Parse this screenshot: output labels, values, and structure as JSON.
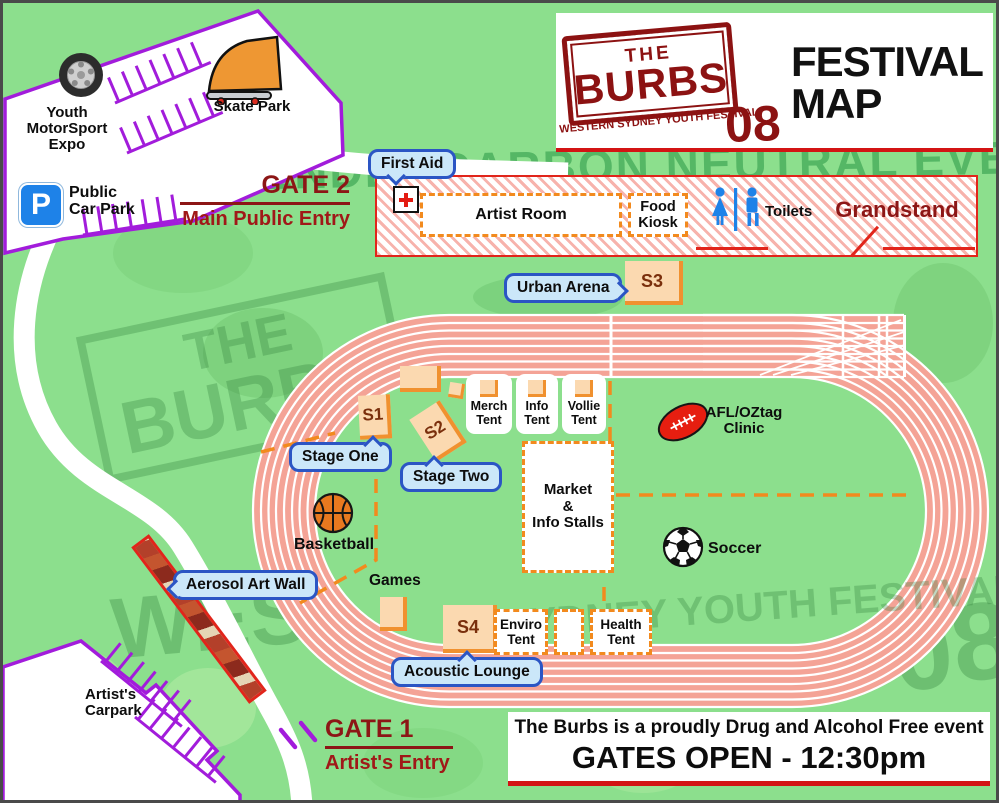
{
  "header": {
    "logo_the": "THE",
    "logo_burbs": "BURBS",
    "logo_tagline": "WESTERN SYDNEY YOUTH FESTIVAL",
    "logo_year": "08",
    "title_line1": "FESTIVAL",
    "title_line2": "MAP"
  },
  "watermarks": {
    "top": "A FRIENDLY CARBON NEUTRAL EVENT",
    "big_left_line1": "THE",
    "big_left_line2": "BURBS",
    "bottom_large": "WESTERN",
    "bottom_small": "SYDNEY YOUTH FESTIVAL",
    "year": "08"
  },
  "carparks": {
    "expo_label": "Youth MotorSport Expo",
    "skate_label": "Skate Park",
    "public_sign_letter": "P",
    "public_label": "Public Car Park",
    "artist_label": "Artist's Carpark"
  },
  "gates": {
    "gate2_title": "GATE 2",
    "gate2_subtitle": "Main Public Entry",
    "gate1_title": "GATE 1",
    "gate1_subtitle": "Artist's Entry"
  },
  "grandstand": {
    "title": "Grandstand",
    "artist_room": "Artist Room",
    "food_kiosk": "Food Kiosk",
    "toilets": "Toilets"
  },
  "callouts": {
    "first_aid": "First Aid",
    "urban_arena": "Urban Arena",
    "stage_one": "Stage One",
    "stage_two": "Stage Two",
    "aerosol_art_wall": "Aerosol Art Wall",
    "acoustic_lounge": "Acoustic Lounge"
  },
  "stages": {
    "s1": "S1",
    "s2": "S2",
    "s3": "S3",
    "s4": "S4"
  },
  "tents": {
    "merch": "Merch Tent",
    "info": "Info Tent",
    "vollie": "Vollie Tent",
    "enviro": "Enviro Tent",
    "health": "Health Tent"
  },
  "market": {
    "line1": "Market",
    "line2": "&",
    "line3": "Info Stalls"
  },
  "activities": {
    "afl": "AFL/OZtag Clinic",
    "basketball": "Basketball",
    "soccer": "Soccer",
    "games": "Games"
  },
  "footer": {
    "line1": "The Burbs is a proudly Drug and Alcohol Free event",
    "line2": "GATES OPEN - 12:30pm"
  },
  "icons": {
    "tire": "tire-icon",
    "skate_ramp": "skate-ramp-icon",
    "parking_sign": "parking-sign",
    "first_aid_cross": "first-aid-cross-icon",
    "toilets": "toilets-icon",
    "afl_ball": "afl-ball-icon",
    "basketball": "basketball-icon",
    "soccer_ball": "soccer-ball-icon"
  },
  "colors": {
    "grass": "#8CDF8D",
    "track": "#F4A396",
    "accent_red": "#D31414",
    "dark_red": "#8C1616",
    "orange": "#F28A1E",
    "peach": "#FBD9B0",
    "purple": "#A21CDB",
    "callout_fill": "#CBE7F9",
    "callout_border": "#2B55C4",
    "sign_blue": "#1E82E8"
  }
}
